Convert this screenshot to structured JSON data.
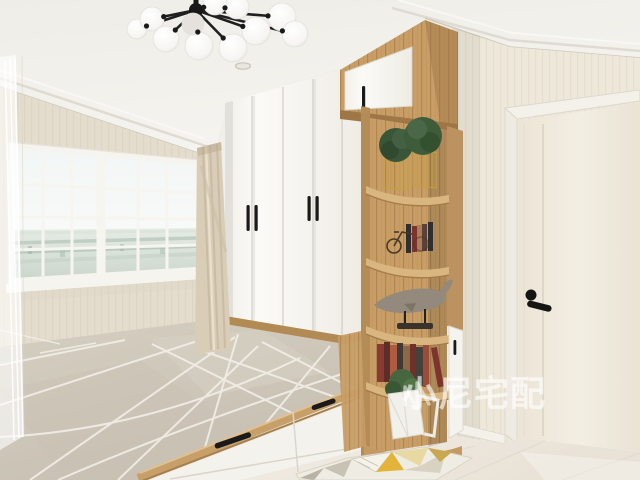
{
  "watermark": {
    "text": "小尼宅配",
    "logo_icon": "brand-logo-icon",
    "color": "#ffffff",
    "opacity": 0.52
  },
  "scene": {
    "objects": [
      "sputnik-chandelier",
      "recessed-downlight",
      "grid-window-with-city-view",
      "sheer-curtain",
      "tan-curtain",
      "white-wardrobe-with-black-handles",
      "upper-storage-cabinet",
      "wood-corner-display-shelf",
      "topiary-plants-in-gold-wire-baskets",
      "bicycle-bookends-with-books",
      "whale-sculpture-on-stand",
      "book-row",
      "white-geometric-planter",
      "side-cabinet-door",
      "tatami-platform-bed",
      "storage-drawers",
      "grey-geometric-mat",
      "white-interior-door-with-black-lever",
      "geometric-area-rug",
      "tile-floor",
      "striped-wallpaper",
      "crown-molding"
    ]
  },
  "palette": {
    "ceiling": "#f1efe9",
    "wall_left": "#e9e2d2",
    "wall_right": "#ece6d8",
    "wood": "#c89e66",
    "wood_dark": "#a57b48",
    "wardrobe_white": "#f7f5f0",
    "handle_black": "#1a1a1a",
    "mat_grey": "#cfc8ba",
    "mat_line_white": "#f2efe8",
    "glass_sky": "#f2f6f5",
    "city_haze": "#b7c6ba",
    "door_cream": "#efe9dd",
    "floor": "#efeae2",
    "curtain_sheer": "#ffffff",
    "curtain_tan": "#d9cdb7",
    "plant_green": "#3e5c3a",
    "basket_gold": "#c79f3f",
    "rug_mustard": "#e2b53a",
    "rug_pale_gold": "#e8d9a2",
    "rug_grey": "#b9b3a5"
  }
}
